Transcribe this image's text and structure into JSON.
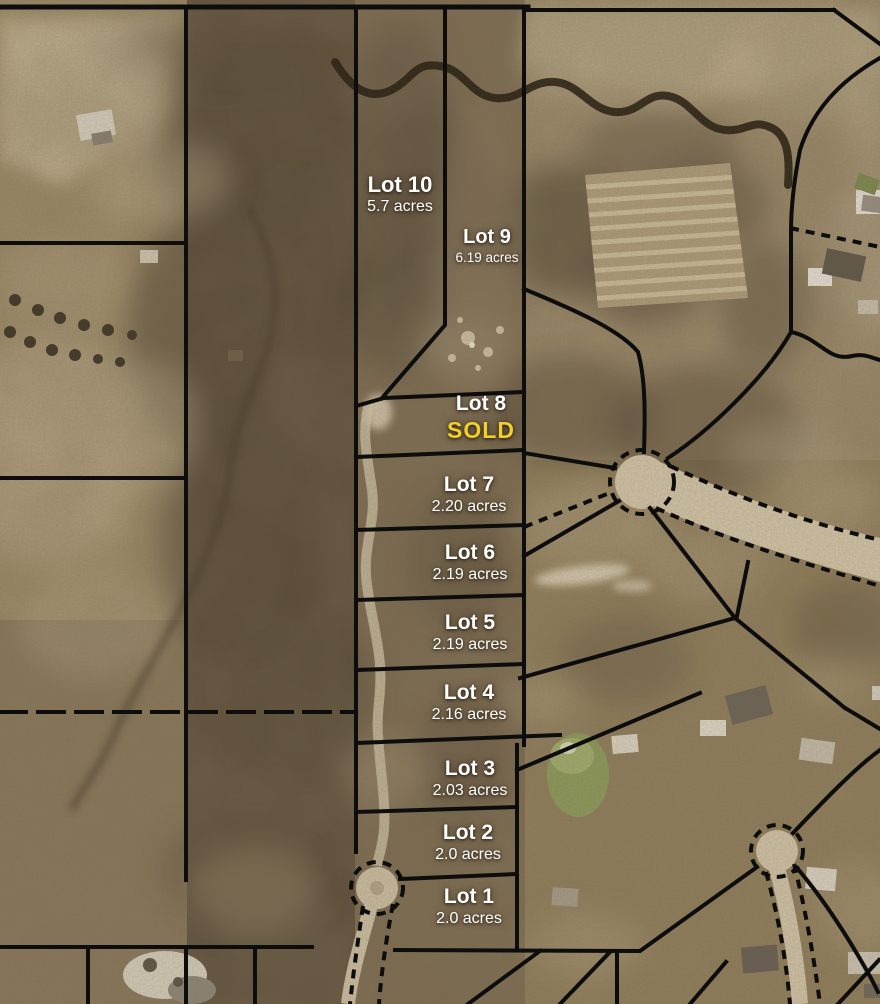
{
  "map": {
    "kind": "aerial-plat-map",
    "colors": {
      "sold_accent": "#f2d028",
      "label_text": "#ffffff",
      "lot_boundary": "#0d0d0d"
    }
  },
  "lots": [
    {
      "id": 1,
      "name": "Lot 1",
      "acreage": "2.0 acres"
    },
    {
      "id": 2,
      "name": "Lot 2",
      "acreage": "2.0 acres"
    },
    {
      "id": 3,
      "name": "Lot 3",
      "acreage": "2.03 acres"
    },
    {
      "id": 4,
      "name": "Lot 4",
      "acreage": "2.16 acres"
    },
    {
      "id": 5,
      "name": "Lot 5",
      "acreage": "2.19 acres"
    },
    {
      "id": 6,
      "name": "Lot 6",
      "acreage": "2.19 acres"
    },
    {
      "id": 7,
      "name": "Lot 7",
      "acreage": "2.20 acres"
    },
    {
      "id": 8,
      "name": "Lot 8",
      "status": "SOLD"
    },
    {
      "id": 9,
      "name": "Lot 9",
      "acreage": "6.19 acres"
    },
    {
      "id": 10,
      "name": "Lot 10",
      "acreage": "5.7 acres"
    }
  ]
}
